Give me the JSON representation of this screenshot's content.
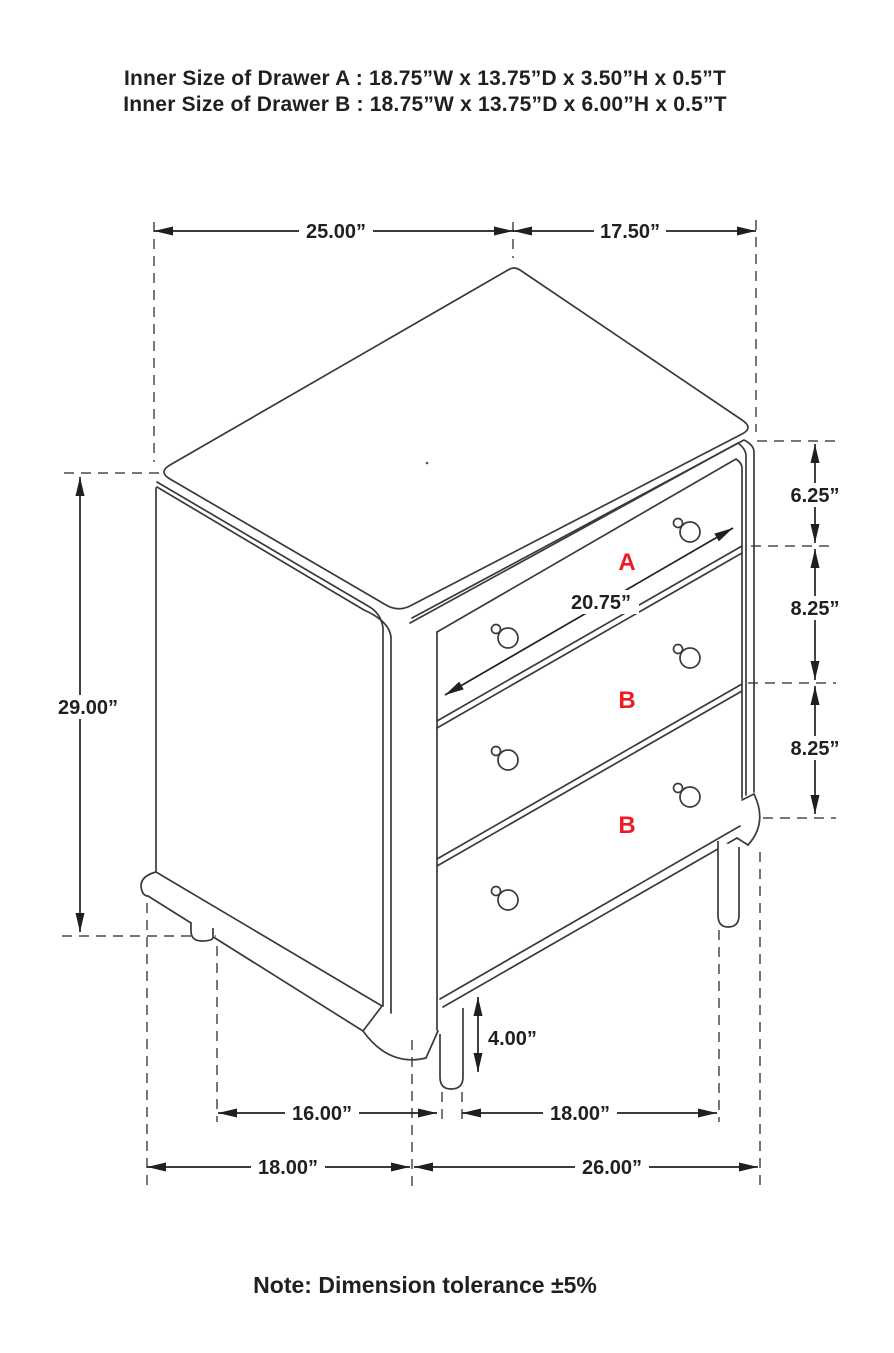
{
  "title_block": {
    "line1": "Inner Size of Drawer A : 18.75”W x 13.75”D x 3.50”H x 0.5”T",
    "line2": "Inner Size of Drawer B : 18.75”W x 13.75”D x 6.00”H x 0.5”T"
  },
  "note": "Note: Dimension tolerance ±5%",
  "drawer_labels": {
    "a": "A",
    "b1": "B",
    "b2": "B"
  },
  "dimensions": {
    "top_width": "25.00”",
    "top_depth": "17.50”",
    "overall_height": "29.00”",
    "drawer_a_front_height": "6.25”",
    "drawer_b1_front_height": "8.25”",
    "drawer_b2_front_height": "8.25”",
    "drawer_diagonal_width": "20.75”",
    "leg_height": "4.00”",
    "foot_spacing_side": "16.00”",
    "foot_spacing_front": "18.00”",
    "base_depth": "18.00”",
    "base_width": "26.00”"
  },
  "colors": {
    "line": "#3a3a3a",
    "text": "#231f20",
    "accent_red": "#ed1c24",
    "background": "#ffffff"
  }
}
